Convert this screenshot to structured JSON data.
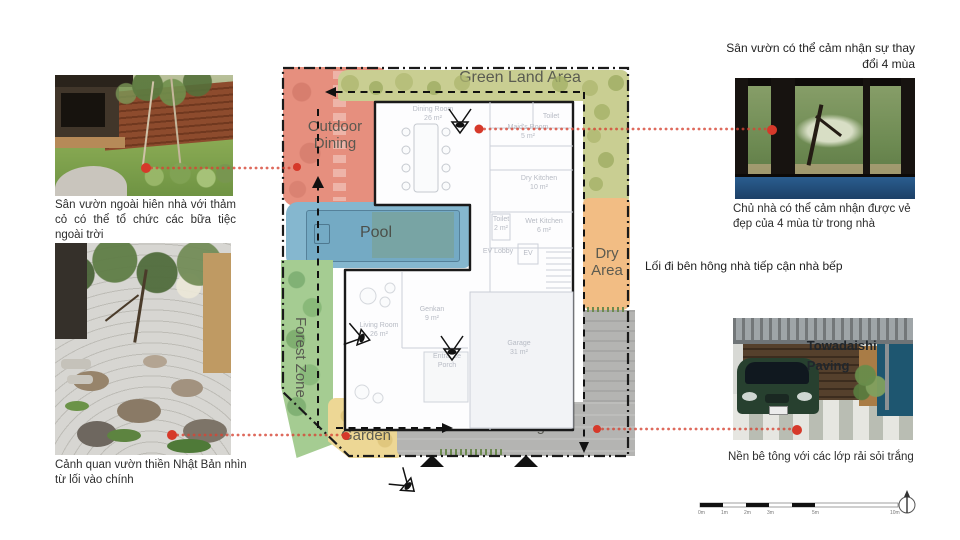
{
  "colors": {
    "accent_red": "#d64535",
    "green_land": "#c9ce92",
    "outdoor_dining": "#e68f7e",
    "pool": "#85b7cf",
    "forest": "#a5cc92",
    "zen": "#edd795",
    "dry_area": "#f2bd84",
    "paving": "#b4b4b2"
  },
  "left_column": {
    "photo1_caption": "Sân vườn ngoài hiên nhà với thảm cỏ có thể tổ chức các bữa tiệc ngoài trời",
    "photo2_caption": "Cảnh quan vườn thiền Nhật Bản nhìn từ lối vào chính"
  },
  "right_column": {
    "note_top": "Sân vườn có thể cảm nhận sự thay đổi 4 mùa",
    "photo3_caption": "Chủ nhà có thể cảm nhận được vẻ đẹp của 4 mùa từ trong nhà",
    "note_side": "Lối đi bên hông nhà tiếp cận nhà bếp",
    "photo4_overlay": "Towadaishi Paving",
    "photo4_caption": "Nền bê tông với các lớp rải sỏi trắng"
  },
  "plan": {
    "zones": {
      "green_land": "Green Land Area",
      "outdoor_dining": "Outdoor Dining",
      "pool": "Pool",
      "dry_area": "Dry Area",
      "forest": "Forest Zone",
      "zen": "Zen Garden",
      "paving": "Paving"
    },
    "rooms": {
      "dining": {
        "name": "Dining Room",
        "area": "26 m²"
      },
      "toilet_top": {
        "name": "Toilet"
      },
      "maid": {
        "name": "Maid's Room",
        "area": "5 m²"
      },
      "dry_kitchen": {
        "name": "Dry Kitchen",
        "area": "10 m²"
      },
      "wet_kitchen": {
        "name": "Wet Kitchen",
        "area": "6 m²"
      },
      "toilet_small": {
        "name": "Toilet",
        "area": "2 m²"
      },
      "ev_lobby": {
        "name": "EV Lobby"
      },
      "ev": {
        "name": "EV"
      },
      "living": {
        "name": "Living Room",
        "area": "26 m²"
      },
      "genkan": {
        "name": "Genkan",
        "area": "9 m²"
      },
      "garage": {
        "name": "Garage",
        "area": "31 m²"
      },
      "porch": {
        "name": "Entrance Porch"
      }
    },
    "scale": {
      "labels": [
        "0m",
        "1m",
        "2m",
        "3m",
        "5m",
        "10m"
      ]
    }
  }
}
